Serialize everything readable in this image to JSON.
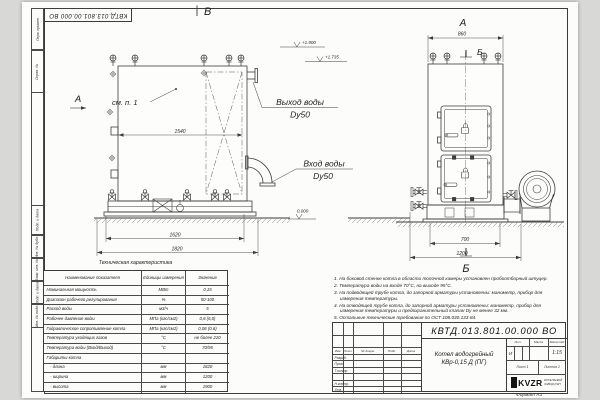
{
  "sheet": {
    "doc_number": "КВТД.013.801.00.000 ВО",
    "format_label": "Формат А3"
  },
  "margin": [
    "Перв. примен.",
    "Справ. №",
    "Подп. и дата",
    "Инв. № дубл.",
    "Взам. инв. №",
    "Подп. и дата",
    "Инв. № подл."
  ],
  "front_view": {
    "view_label": "В",
    "section_arrow_label": "А",
    "see_note_label": "см. п. 1",
    "dim_inner_width": "1540",
    "dim_base_width": "1620",
    "dim_overall_length": "1820",
    "elevation_top": "+1.900",
    "elevation_mid": "+1.735",
    "elevation_zero": "0.000",
    "outlet_line1": "Выход воды",
    "outlet_line2": "Dy50",
    "inlet_line1": "Вход воды",
    "inlet_line2": "Dy50"
  },
  "side_view": {
    "view_label": "А",
    "node_label_top": "Б",
    "node_label_bottom": "Б",
    "dim_width": "860",
    "dim_base_width": "700",
    "dim_overall_width": "1200"
  },
  "spec": {
    "title": "Техническая характеристика",
    "headers": [
      "Наименование показателя",
      "Единицы измерения",
      "Значение"
    ],
    "rows": [
      [
        "Номинальная мощность",
        "МВт",
        "0,15"
      ],
      [
        "Диапазон рабочего регулирования",
        "%",
        "50-100"
      ],
      [
        "Расход воды",
        "м3/ч",
        "5"
      ],
      [
        "Рабочее давление воды",
        "МПа (кгс/см2)",
        "0,6 (6,0)"
      ],
      [
        "Гидравлическое сопротивление котла",
        "МПа (кгс/см2)",
        "0,06 (0,6)"
      ],
      [
        "Температура уходящих газов",
        "°С",
        "не более 220"
      ],
      [
        "Температура воды (Вход/Выход)",
        "°С",
        "70/95"
      ],
      [
        "Габариты котла",
        "",
        ""
      ],
      [
        "   - длина",
        "мм",
        "1820"
      ],
      [
        "   - ширина",
        "мм",
        "1200"
      ],
      [
        "   - высота",
        "мм",
        "1900"
      ]
    ]
  },
  "notes": [
    "1. На боковой стенке котла в области топочной камеры установлен пробоотборный штуцер.",
    "2. Температура воды на входе 70°С, на выходе 95°С.",
    "3. На подводящей трубе котла, до запорной арматуры установлены: манометр, прибор для измерения температуры.",
    "4. На отводящей трубе котла, до запорной арматуры установлены: манометр, прибор для измерения температуры и предохранительный клапан Dу не менее 32 мм.",
    "5. Остальные технические требования по ОСТ 108.030.133-84."
  ],
  "title_block": {
    "doc_number": "КВТД.013.801.00.000 ВО",
    "product_line1": "Котел водогрейный",
    "product_line2": "КВр-0,15 Д (ПГ)",
    "change_cols": [
      "Изм.",
      "Лист",
      "№ докум.",
      "Подп.",
      "Дата"
    ],
    "roles": [
      "Разраб.",
      "Пров.",
      "Т.контр.",
      "Н.контр.",
      "Утв."
    ],
    "lit_header": "Лит.",
    "mass_header": "Масса",
    "scale_header": "Масштаб",
    "lit_value": "И",
    "scale_value": "1:15",
    "sheet_label": "Лист",
    "sheet_value": "1",
    "sheets_label": "Листов",
    "sheets_value": "2",
    "logo": "KVZR",
    "company_line1": "КОТЕЛЬНЫЙ",
    "company_line2": "ЗАВОД РЭП"
  }
}
